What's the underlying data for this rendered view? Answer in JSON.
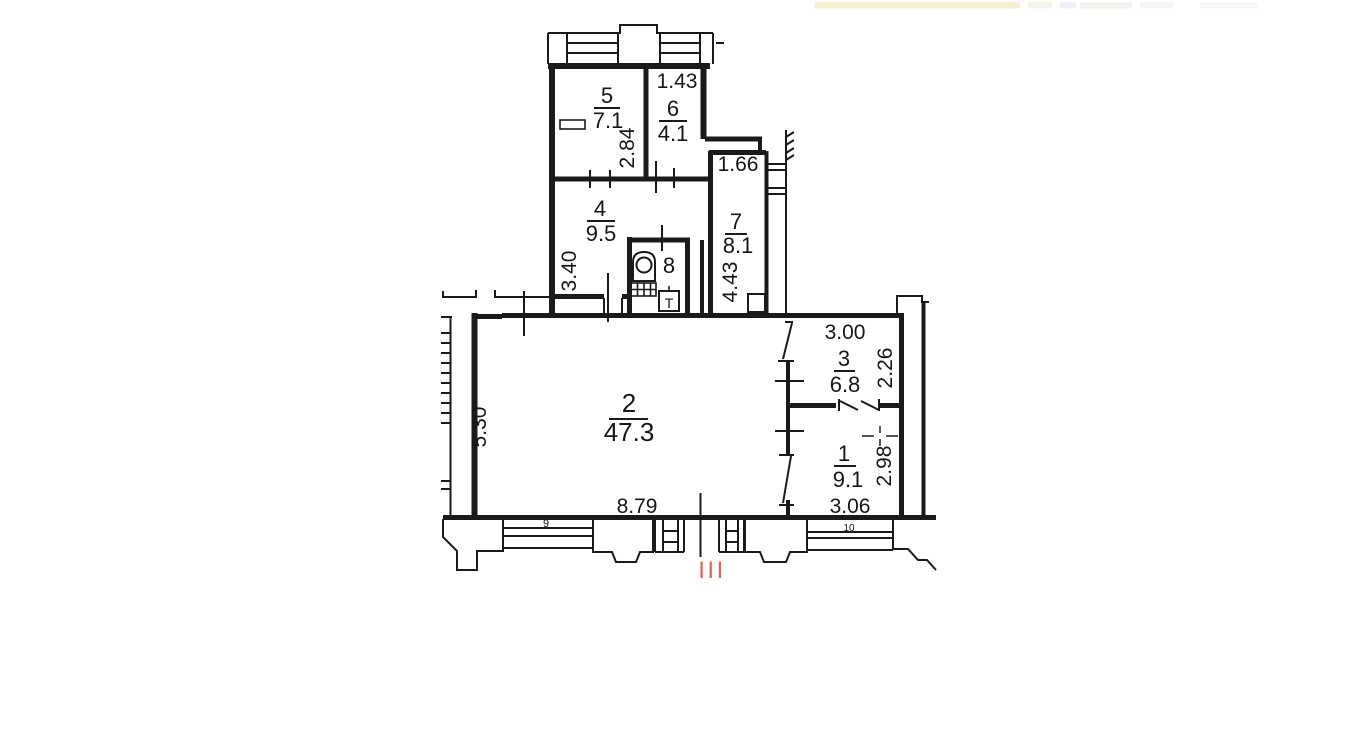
{
  "floor_plan": {
    "colors": {
      "wall": "#1a1a1a",
      "entrance_marker": "#e2604f"
    },
    "rooms": [
      {
        "number": "1",
        "area": "9.1"
      },
      {
        "number": "2",
        "area": "47.3"
      },
      {
        "number": "3",
        "area": "6.8"
      },
      {
        "number": "4",
        "area": "9.5"
      },
      {
        "number": "5",
        "area": "7.1"
      },
      {
        "number": "6",
        "area": "4.1"
      },
      {
        "number": "7",
        "area": "8.1"
      },
      {
        "number": "8",
        "area": ""
      }
    ],
    "dimensions": {
      "room6_width": "1.43",
      "room6_depth": "2.84",
      "room4_depth": "3.40",
      "room7_width": "1.66",
      "room7_depth": "4.43",
      "room2_depth": "5.30",
      "room2_width": "8.79",
      "room3_width": "3.00",
      "room3_depth": "2.26",
      "room1_depth": "2.98",
      "room1_width": "3.06"
    },
    "facade_labels": {
      "window_9": "9",
      "window_10": "10"
    },
    "entrance": {
      "marker": "III"
    },
    "fixtures": {
      "water_heater_label": "T"
    }
  }
}
